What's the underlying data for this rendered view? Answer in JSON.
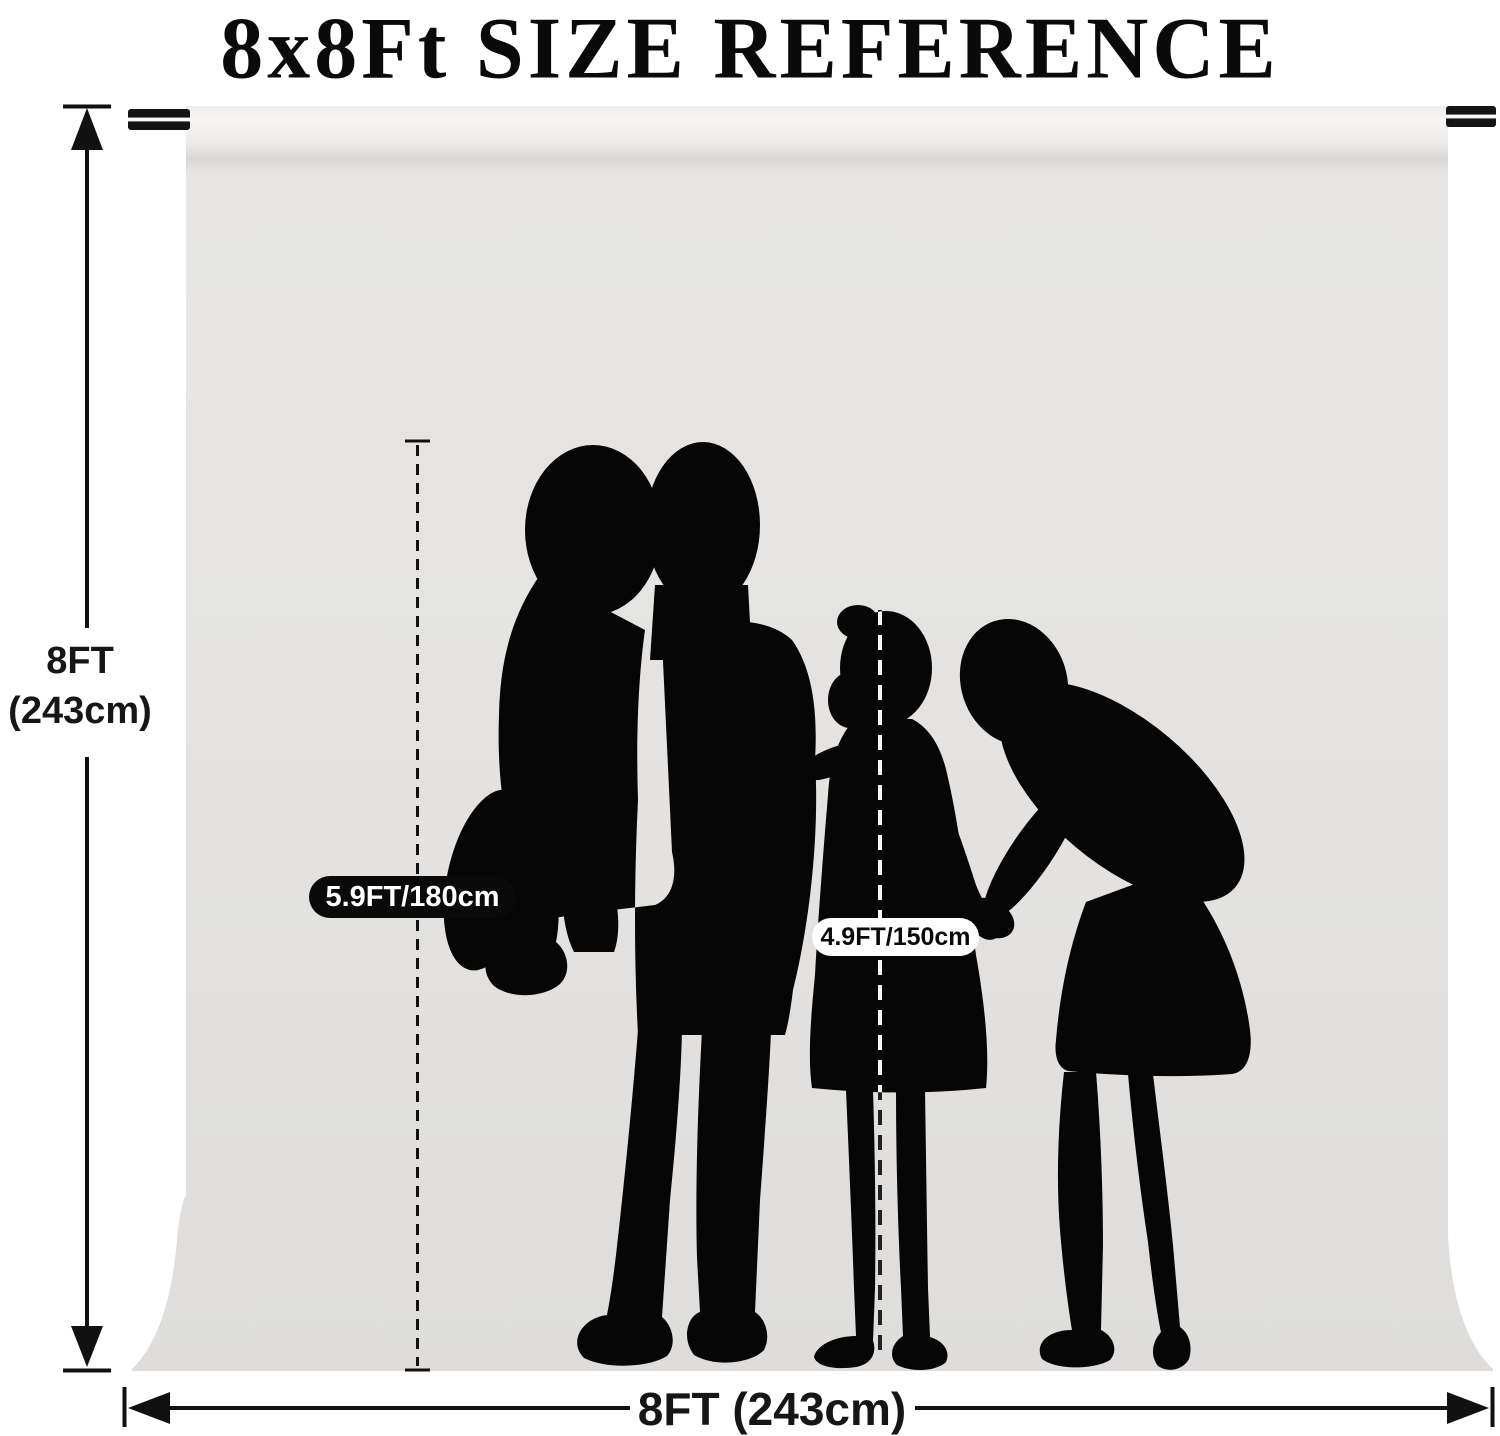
{
  "title": {
    "text": "8x8Ft SIZE REFERENCE"
  },
  "dimension_labels": {
    "height": {
      "line1": "8FT",
      "line2": "(243cm)"
    },
    "width": {
      "text": "8FT (243cm)"
    }
  },
  "height_markers": {
    "adult": {
      "text": "5.9FT/180cm",
      "badge_bg": "#0a0a0a",
      "badge_fg": "#ffffff"
    },
    "child": {
      "text": "4.9FT/150cm",
      "badge_bg": "#ffffff",
      "badge_fg": "#0a0a0a"
    }
  },
  "colors": {
    "page_background": "#ffffff",
    "backdrop_gray": "#e3e2e0",
    "backdrop_roll_highlight": "#f6f5f3",
    "silhouette": "#060606",
    "annotation": "#111111",
    "rod": "#141414"
  },
  "icons": {
    "family_silhouette": "man-holding-boy-with-girl-and-woman",
    "height_arrow": "vertical-double-arrow",
    "width_arrow": "horizontal-double-arrow",
    "backdrop_rod": "support-crossbar"
  }
}
